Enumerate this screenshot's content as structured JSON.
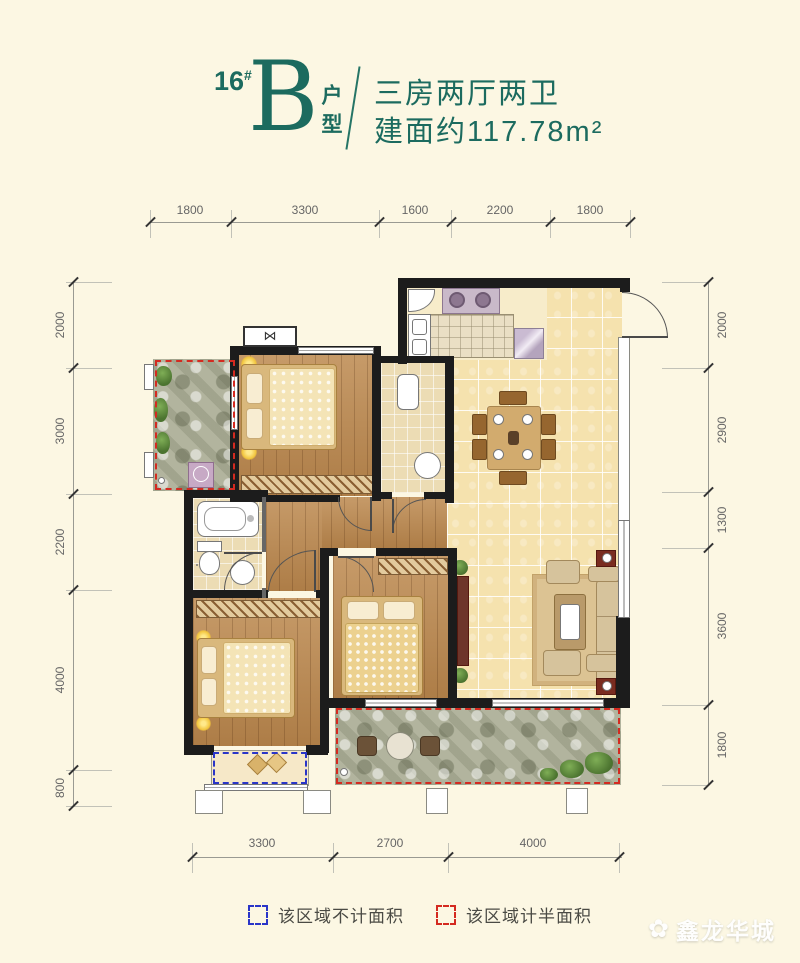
{
  "header": {
    "block_number": "16",
    "block_hash": "#",
    "unit_letter": "B",
    "unit_label": "户型",
    "line1": "三房两厅两卫",
    "line2": "建面约117.78m²",
    "accent_color": "#1c6b5f"
  },
  "dimensions": {
    "top": [
      "1800",
      "3300",
      "1600",
      "2200",
      "1800"
    ],
    "left": [
      "2000",
      "3000",
      "2200",
      "4000",
      "800"
    ],
    "right": [
      "2000",
      "2900",
      "1300",
      "3600",
      "1800"
    ],
    "bottom": [
      "3300",
      "2700",
      "4000"
    ]
  },
  "legend": {
    "items": [
      {
        "label": "该区域不计面积",
        "color": "#2a35c8"
      },
      {
        "label": "该区域计半面积",
        "color": "#d42a20"
      }
    ]
  },
  "watermark": {
    "text": "鑫龙华城",
    "icon": "flower-icon"
  }
}
